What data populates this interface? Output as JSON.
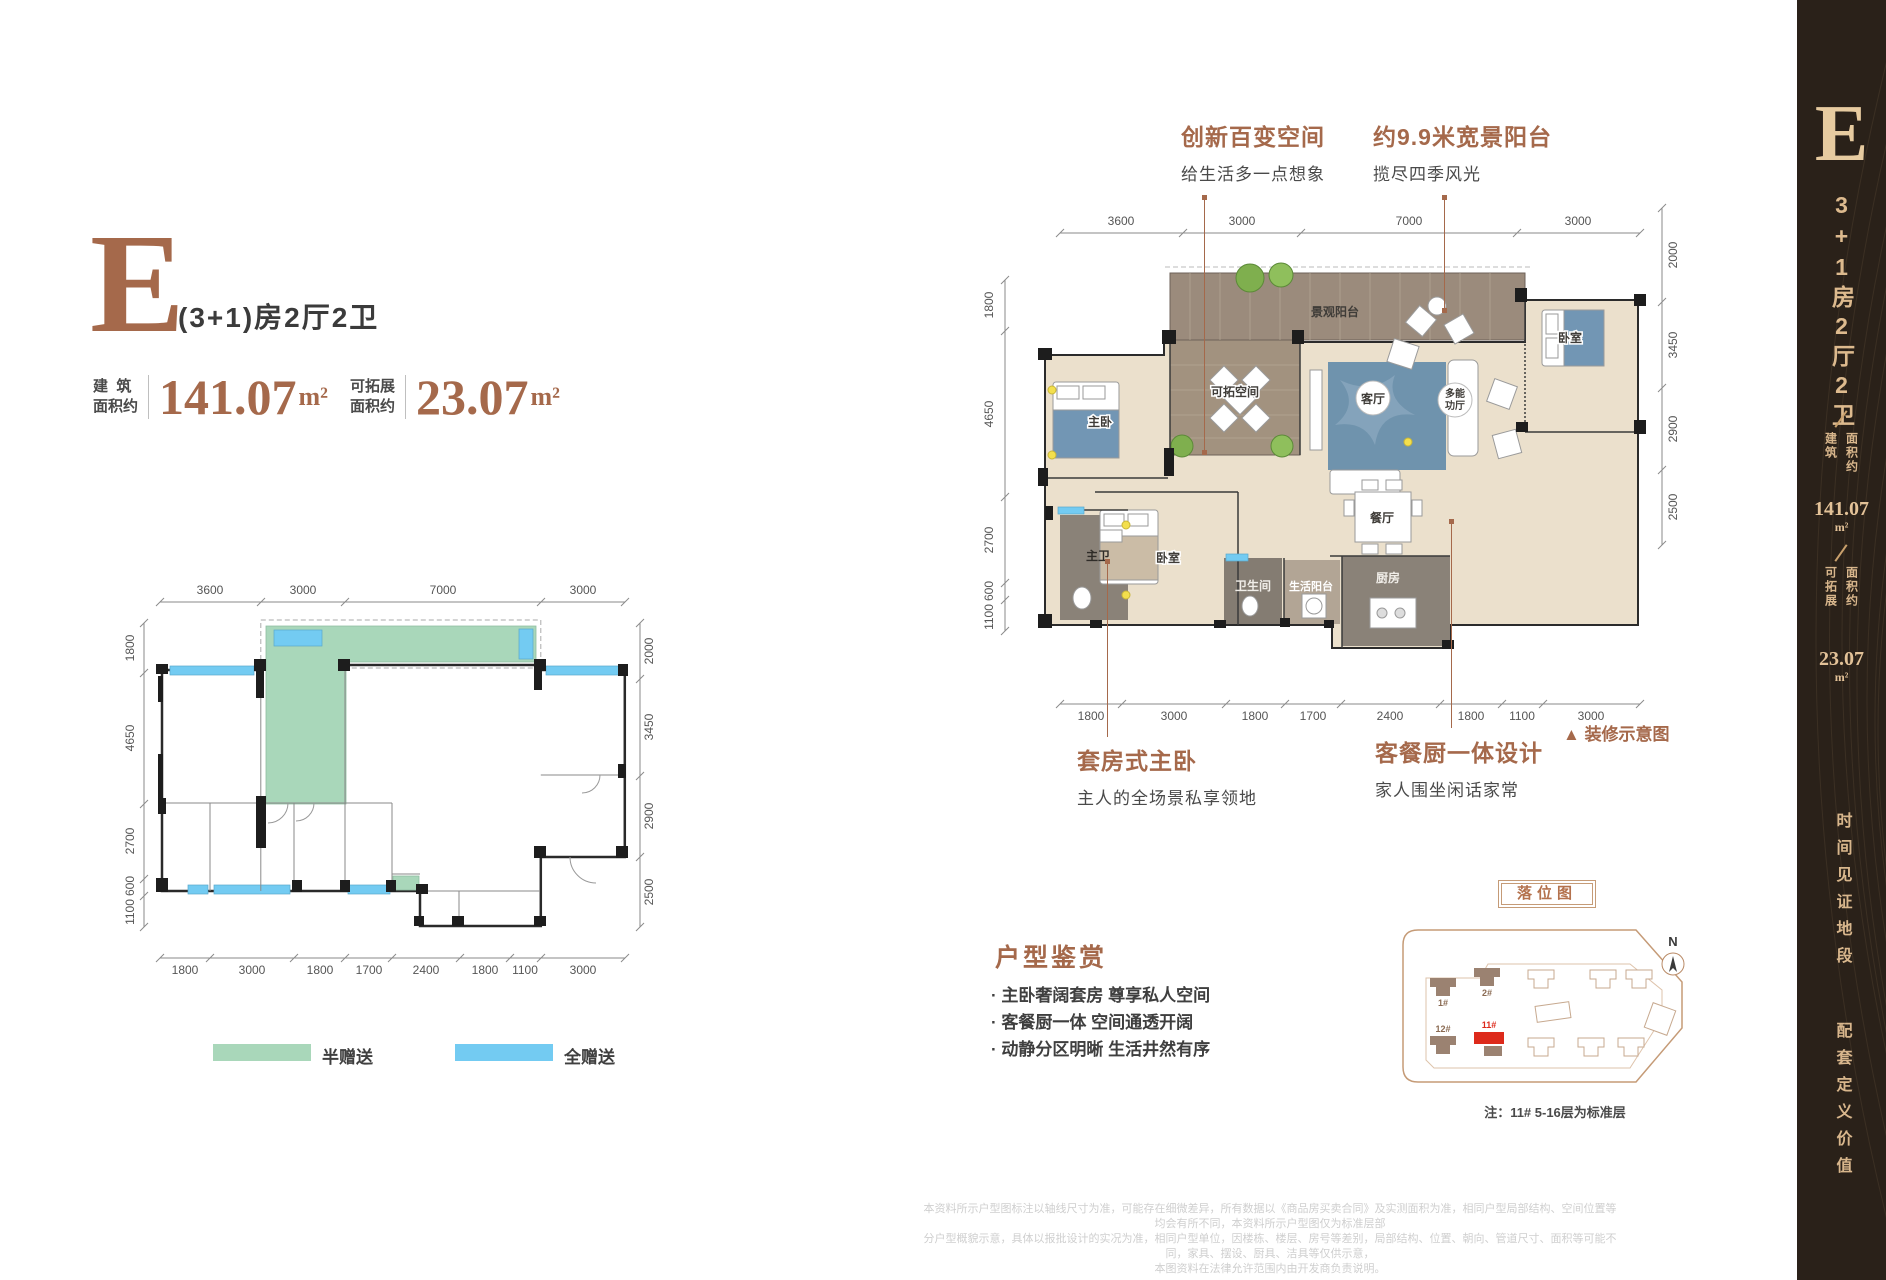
{
  "colors": {
    "accent_brown": "#A5694B",
    "sidebar_bg": "#2A2119",
    "sidebar_gold": "#DDBA8E",
    "half_gift_green": "#A9D7BA",
    "full_gift_blue": "#73CBF2",
    "highlight_red": "#DD2A1B"
  },
  "header": {
    "letter": "E",
    "type_desc": "(3+1)房2厅2卫",
    "area1_label": "建  筑\n面积约",
    "area1_value": "141.07",
    "area1_unit": "m²",
    "area2_label": "可拓展\n面积约",
    "area2_value": "23.07",
    "area2_unit": "m²"
  },
  "callouts": {
    "c1_title": "创新百变空间",
    "c1_sub": "给生活多一点想象",
    "c2_title": "约9.9米宽景阳台",
    "c2_sub": "揽尽四季风光",
    "c3_title": "套房式主卧",
    "c3_sub": "主人的全场景私享领地",
    "c4_title": "客餐厨一体设计",
    "c4_sub": "家人围坐闲话家常",
    "deco_marker": "▲",
    "deco_note": "装修示意图"
  },
  "dims": {
    "top": [
      "3600",
      "3000",
      "7000",
      "3000"
    ],
    "left": [
      "1800",
      "4650",
      "2700",
      "600",
      "1100"
    ],
    "right": [
      "2000",
      "3450",
      "2900",
      "2500"
    ],
    "bottom": [
      "1800",
      "3000",
      "1800",
      "1700",
      "2400",
      "1800",
      "1100",
      "3000"
    ]
  },
  "rooms": {
    "balcony": "景观阳台",
    "flex": "可拓空间",
    "living": "客厅",
    "multi_line1": "多能",
    "multi_line2": "功厅",
    "master": "主卧",
    "bedroom2": "卧室",
    "bedroom_right": "卧室",
    "dining": "餐厅",
    "master_bath": "主卫",
    "bath": "卫生间",
    "service_balcony": "生活阳台",
    "kitchen": "厨房"
  },
  "legend": {
    "items": [
      {
        "label": "半赠送",
        "color": "#A9D7BA"
      },
      {
        "label": "全赠送",
        "color": "#73CBF2"
      }
    ]
  },
  "appreciation": {
    "title": "户型鉴赏",
    "bullets": [
      "· 主卧奢阔套房  尊享私人空间",
      "· 客餐厨一体  空间通透开阔",
      "· 动静分区明晰  生活井然有序"
    ]
  },
  "siteplan": {
    "label": "落位图",
    "north": "N",
    "note": "注：11# 5-16层为标准层",
    "buildings": {
      "b1": "1#",
      "b2": "2#",
      "b12": "12#",
      "b11": "11#"
    }
  },
  "sidebar": {
    "letter": "E",
    "type_vertical": "3+1房2厅2卫",
    "area1_col1": "建筑",
    "area1_col2": "面积约",
    "area1_value": "141.07",
    "area1_unit": "m²",
    "area2_col1": "可拓展",
    "area2_col2": "面积约",
    "area2_value": "23.07",
    "area2_unit": "m²",
    "slogan1": "时间见证地段",
    "slogan2": "配套定义价值"
  },
  "disclaimer": {
    "line1": "本资料所示户型图标注以轴线尺寸为准，可能存在细微差异，所有数据以《商品房买卖合同》及实测面积为准，相同户型局部结构、空间位置等均会有所不同，本资料所示户型图仅为标准层部",
    "line2": "分户型概貌示意，具体以报批设计的实况为准，相同户型单位，因楼栋、楼层、房号等差别，局部结构、位置、朝向、管道尺寸、面积等可能不同，家具、摆设、厨具、洁具等仅供示意，",
    "line3": "本图资料在法律允许范围内由开发商负责说明。"
  }
}
